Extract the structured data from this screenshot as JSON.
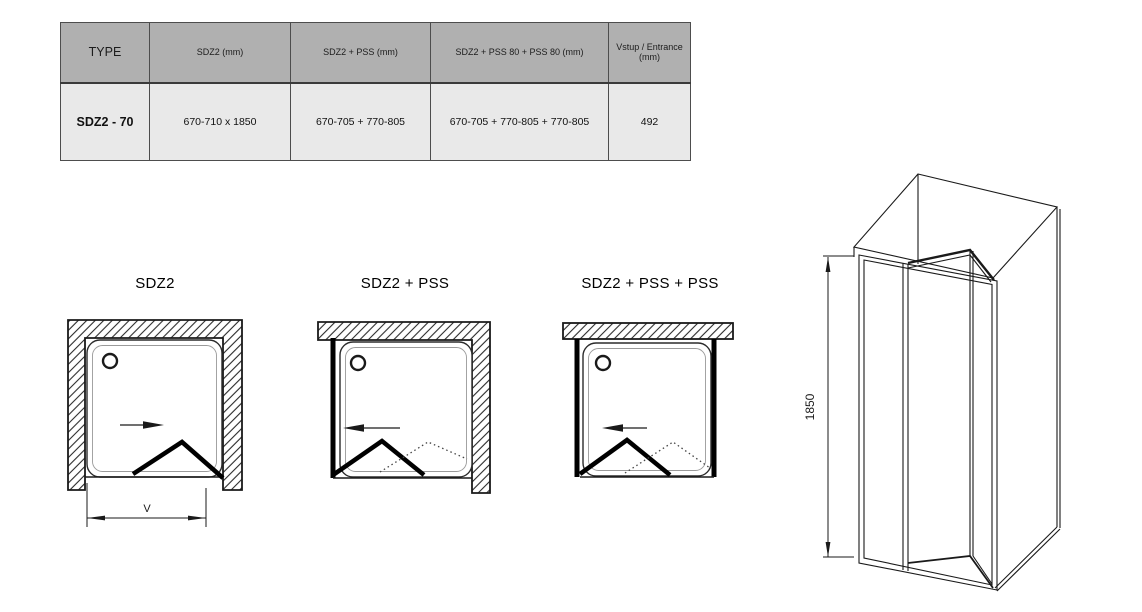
{
  "table": {
    "headers": [
      "TYPE",
      "SDZ2 (mm)",
      "SDZ2 + PSS (mm)",
      "SDZ2 + PSS 80 + PSS 80 (mm)",
      "Vstup / Entrance (mm)"
    ],
    "rows": [
      {
        "type": "SDZ2 - 70",
        "sdz2": "670-710 x 1850",
        "sdz2_pss": "670-705 + 770-805",
        "sdz2_pss80_pss80": "670-705 + 770-805 + 770-805",
        "entrance": "492"
      }
    ]
  },
  "diagrams": [
    {
      "title": "SDZ2",
      "entrance_label": "V"
    },
    {
      "title": "SDZ2 + PSS"
    },
    {
      "title": "SDZ2 + PSS + PSS"
    }
  ],
  "iso_drawing": {
    "height_label": "1850"
  },
  "colors": {
    "header_bg": "#b0b0b0",
    "row_bg": "#e9e9e9",
    "table_border": "#4d4d4d",
    "line": "#1a1a1a"
  }
}
